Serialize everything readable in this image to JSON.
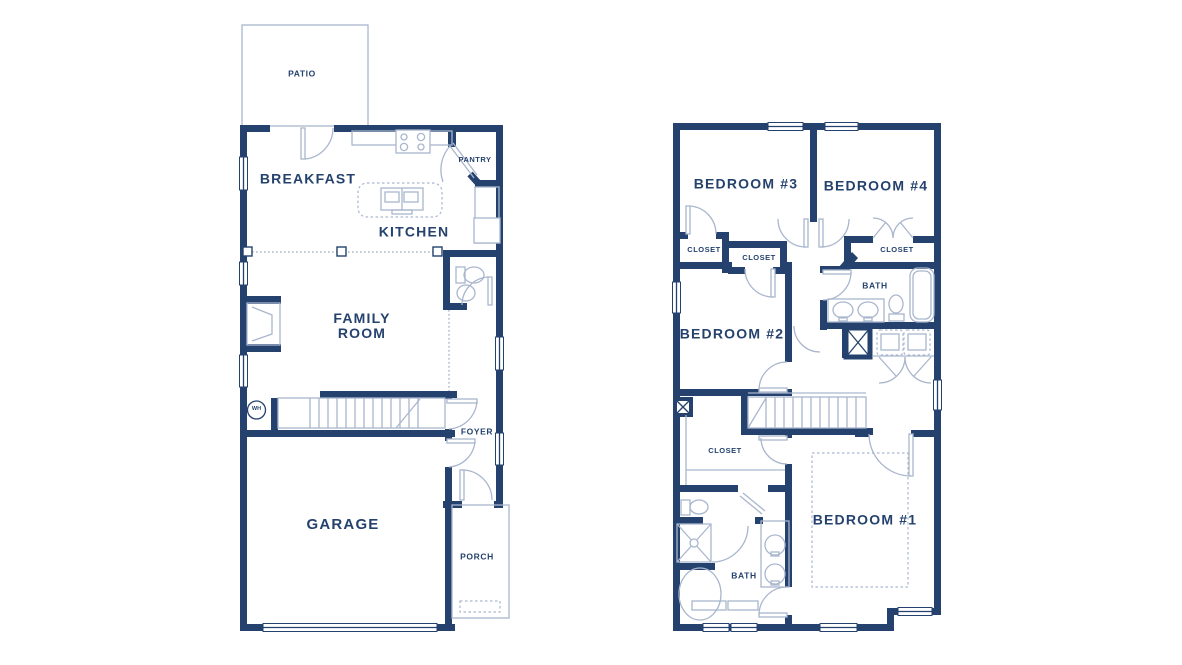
{
  "colors": {
    "wall": "#25426e",
    "fixture": "#a9b6cd",
    "label": "#25426e",
    "background": "#ffffff"
  },
  "first_floor": {
    "labels": {
      "patio": "PATIO",
      "breakfast": "BREAKFAST",
      "kitchen": "KITCHEN",
      "pantry": "PANTRY",
      "family_room": "FAMILY\nROOM",
      "water_heater": "WH",
      "foyer": "FOYER",
      "garage": "GARAGE",
      "porch": "PORCH"
    }
  },
  "second_floor": {
    "labels": {
      "bedroom_3": "BEDROOM #3",
      "bedroom_4": "BEDROOM #4",
      "closet_bedroom_3": "CLOSET",
      "closet_hall": "CLOSET",
      "closet_bedroom_4": "CLOSET",
      "bath_hall": "BATH",
      "bedroom_2": "BEDROOM #2",
      "closet_owner": "CLOSET",
      "bath_owner": "BATH",
      "bedroom_1": "BEDROOM #1"
    }
  }
}
